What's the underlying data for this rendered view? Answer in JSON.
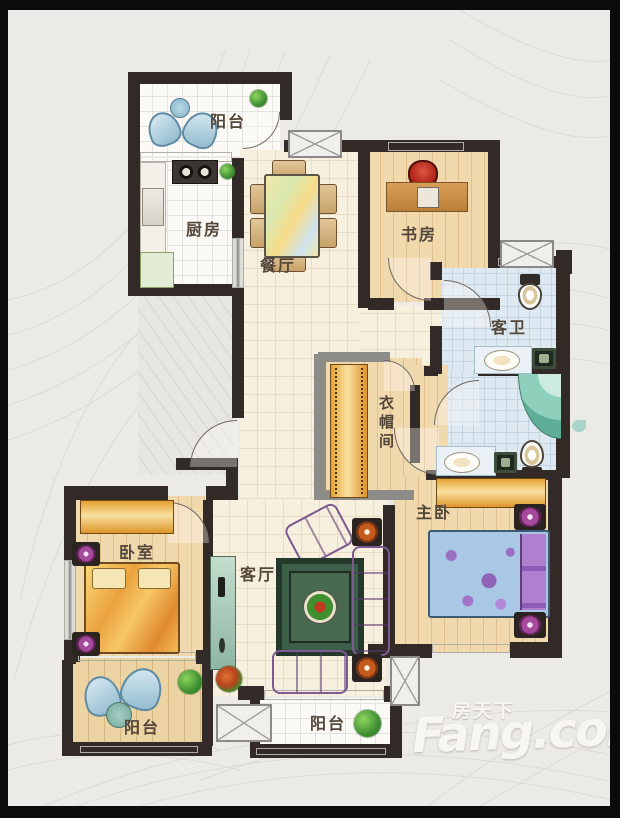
{
  "watermark": {
    "brand_cn": "房天下",
    "brand_en": "Fang.com"
  },
  "rooms": {
    "balcony_top": {
      "label": "阳台"
    },
    "kitchen": {
      "label": "厨房"
    },
    "dining_room": {
      "label": "餐厅"
    },
    "study": {
      "label": "书房"
    },
    "guest_bathroom": {
      "label": "客卫"
    },
    "walk_in_closet": {
      "label": "衣帽间"
    },
    "master_bedroom": {
      "label": "主卧"
    },
    "bedroom": {
      "label": "卧室"
    },
    "living_room": {
      "label": "客厅"
    },
    "balcony_bottom_left": {
      "label": "阳台"
    },
    "balcony_bottom_center": {
      "label": "阳台"
    }
  },
  "colors": {
    "wall": "#312a26",
    "wood_floor": "#f1d9ae",
    "tile_blue": "#dfe9f1",
    "accent_orange": "#e8a93c",
    "sofa_purple": "#c9a3d8",
    "watermark_white": "#f8f6f2"
  }
}
